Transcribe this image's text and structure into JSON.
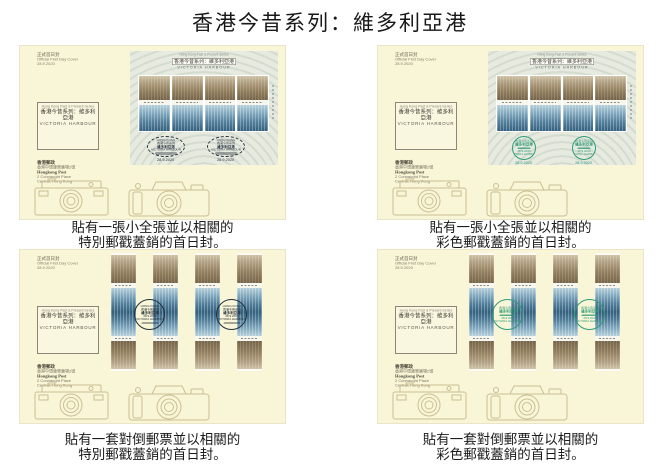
{
  "page": {
    "title": "香港今昔系列：維多利亞港"
  },
  "cover_common": {
    "corner_line1": "正式首日封",
    "corner_line2": "Official First Day Cover",
    "corner_line3": "28.9.2020",
    "label_line1": "Hong Kong Past & Present Series",
    "label_line2": "香港今昔系列：維多利亞港",
    "label_line3": "VICTORIA HARBOUR",
    "addr_line1": "香港郵政",
    "addr_line2": "香港中環康樂廣場2號",
    "addr_line3": "Hongkong Post",
    "addr_line4": "2 Connaught Place",
    "addr_line5": "Central, Hong Kong",
    "sheet_head_line1": "Hong Kong Past & Present Series",
    "sheet_head_line2": "香港今昔系列：維多利亞港",
    "sheet_head_line3": "VICTORIA HARBOUR",
    "postmark_date": "28.9.2020"
  },
  "postmark_special": {
    "line1": "HONG KONG",
    "line2": "香港今昔系列",
    "line3": "維多利亞港",
    "date": "28.9.2020",
    "line4": "VICTORIA HARBOUR"
  },
  "postmark_colour": {
    "line1": "香港今昔系列",
    "line2": "維多利亞港",
    "date": "28.9.2020",
    "line3": "VICTORIA HARBOUR"
  },
  "covers": [
    {
      "id": "top-left",
      "format": "souvenir-sheet",
      "postmark_style": "special",
      "caption_line1": "貼有一張小全張並以相關的",
      "caption_line2": "特別郵戳蓋銷的首日封。"
    },
    {
      "id": "top-right",
      "format": "souvenir-sheet",
      "postmark_style": "colour",
      "caption_line1": "貼有一張小全張並以相關的",
      "caption_line2": "彩色郵戳蓋銷的首日封。"
    },
    {
      "id": "bottom-left",
      "format": "tete-beche-strips",
      "postmark_style": "special",
      "caption_line1": "貼有一套對倒郵票並以相關的",
      "caption_line2": "特別郵戳蓋銷的首日封。"
    },
    {
      "id": "bottom-right",
      "format": "tete-beche-strips",
      "postmark_style": "colour",
      "caption_line1": "貼有一套對倒郵票並以相關的",
      "caption_line2": "彩色郵戳蓋銷的首日封。"
    }
  ],
  "colors": {
    "envelope": "#f9f5d7",
    "sheet_background": "#e6eadf",
    "postmark_special": "#26303d",
    "postmark_colour": "#2f9b77",
    "camera_line": "#c7ba8c"
  }
}
